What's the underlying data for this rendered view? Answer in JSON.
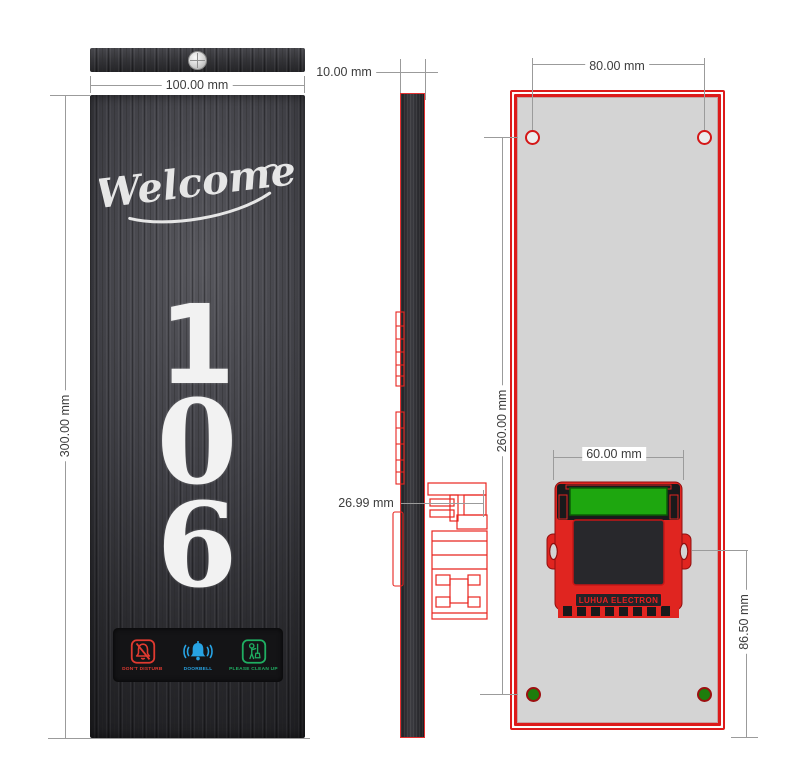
{
  "front_view": {
    "welcome_text": "Welcome",
    "room_number": "106",
    "digits": [
      "1",
      "0",
      "6"
    ],
    "buttons": [
      {
        "name": "do-not-disturb",
        "label": "DON'T DISTURB",
        "color": "#e03a30"
      },
      {
        "name": "doorbell",
        "label": "DOORBELL",
        "color": "#27a3e3"
      },
      {
        "name": "please-clean-up",
        "label": "PLEASE CLEAN UP",
        "color": "#1fae62"
      }
    ]
  },
  "back_view": {
    "module_label": "LUHUA ELECTRON"
  },
  "dimensions": {
    "panel_width": "100.00 mm",
    "panel_height": "300.00 mm",
    "panel_thickness": "10.00 mm",
    "mount_depth": "26.99 mm",
    "hole_spacing_horizontal": "80.00 mm",
    "hole_spacing_vertical": "260.00 mm",
    "module_width": "60.00 mm",
    "module_bottom_offset": "86.50 mm"
  },
  "colors": {
    "outline_red": "#e02520",
    "pcb_green": "#1ea70f",
    "front_panel_dark": "#2b2b2e",
    "back_panel_gray": "#d4d4d4",
    "dimension_line_gray": "#9b9b9b"
  }
}
